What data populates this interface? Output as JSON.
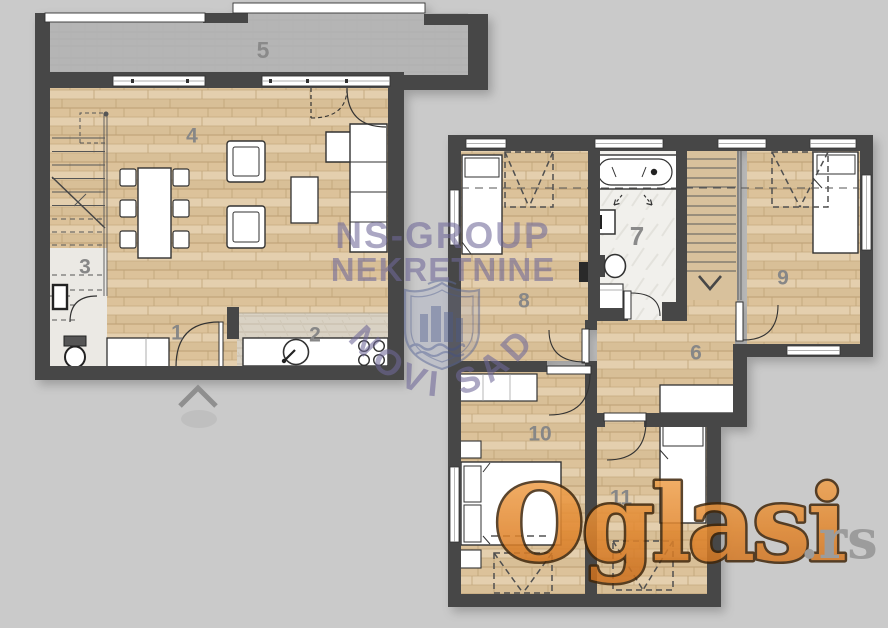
{
  "lower_plan": {
    "labels": {
      "entry_hall": "1",
      "kitchen": "2",
      "bathroom": "3",
      "living_room": "4",
      "terrace": "5"
    }
  },
  "upper_plan": {
    "labels": {
      "hallway": "6",
      "bathroom": "7",
      "bedroom_1": "8",
      "bedroom_2": "9",
      "bedroom_3": "10",
      "bedroom_4": "11"
    }
  },
  "watermarks": {
    "agency_line1": "NS-GROUP",
    "agency_line2": "NEKRETNINE",
    "agency_city": "NOVI SAD",
    "portal_name": "Oglasi",
    "portal_suffix": ".rs"
  },
  "palette": {
    "background": "#cacaca",
    "wall": "#474747",
    "wood_floor": "#e0c9a4",
    "terrace_floor": "#b5b5b5",
    "bath_tile": "#f1f0ec",
    "kitchen_tile": "#d9d2c4",
    "furniture": "#ffffff",
    "outline": "#333333",
    "room_label": "#878787",
    "watermark_purple": "#6f6899",
    "logo_orange": "#e2872e",
    "logo_outline": "#41270b",
    "logo_tld_gray": "#959595"
  }
}
